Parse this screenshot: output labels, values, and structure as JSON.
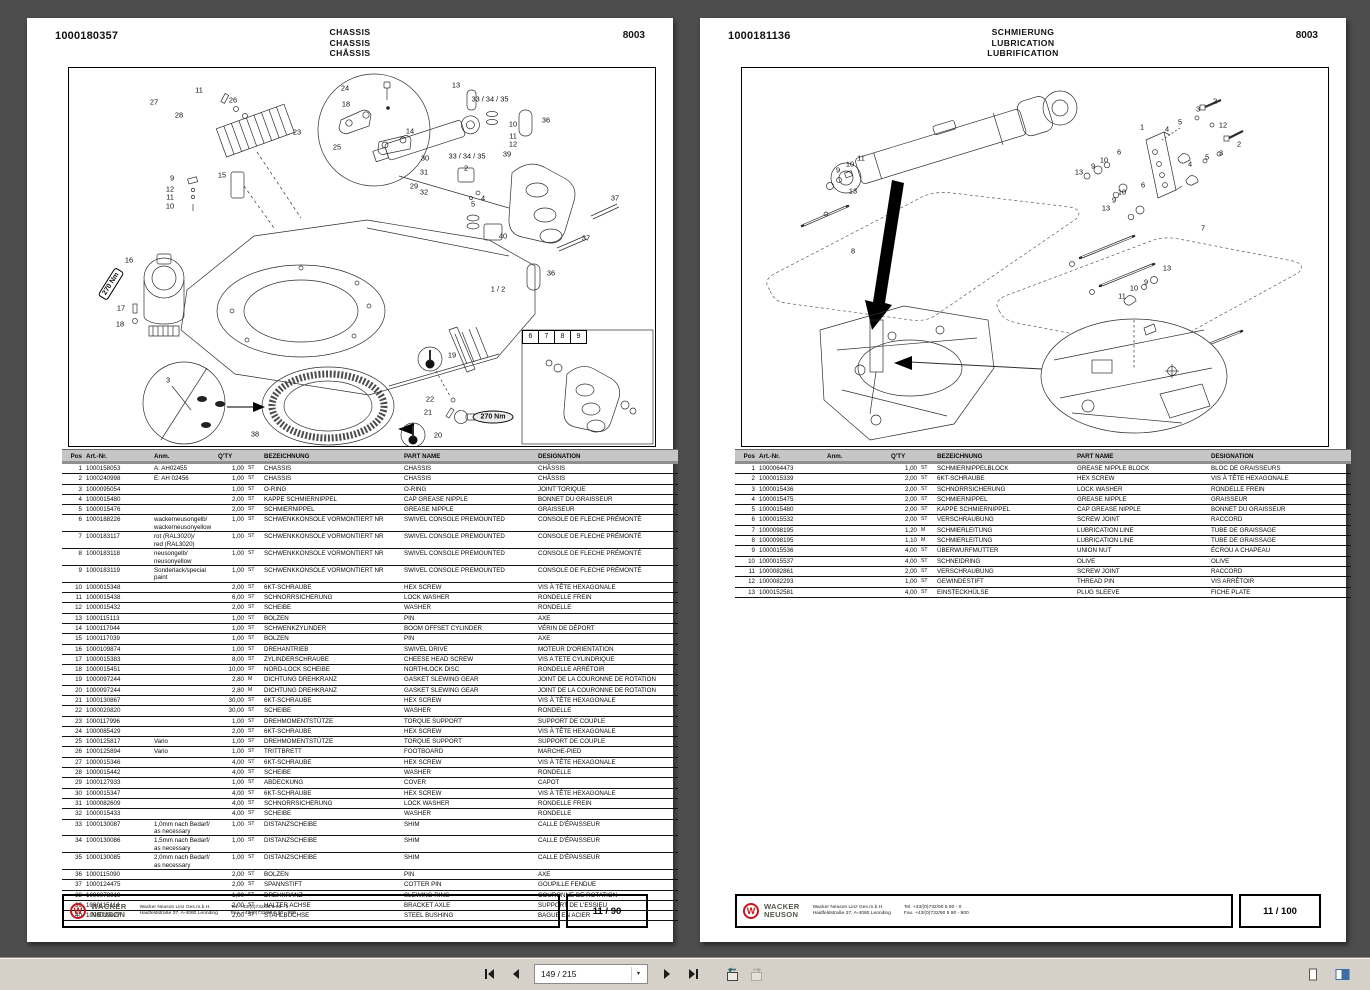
{
  "viewer": {
    "toolbar": {
      "page_field": "149 / 215",
      "icons": [
        "first-page",
        "previous-page",
        "next-page",
        "last-page",
        "previous-view",
        "next-view",
        "single-page-view",
        "facing-pages-view"
      ]
    }
  },
  "table_headers": {
    "pos": "Pos",
    "art": "Art.-Nr.",
    "anm": "Anm.",
    "qty": "Q'TY",
    "bez": "BEZEICHNUNG",
    "part": "PART NAME",
    "des": "DESIGNATION"
  },
  "footer": {
    "brand1": "WACKER",
    "brand2": "NEUSON",
    "company": "Wacker Neuson Linz  Ges.m.b.H.",
    "address": "Haidfeldstraße 37, A-4060 Leonding",
    "tel": "Tel. +43/(0)732/90 5 90 - 0",
    "fax": "Fax. +43/(0)732/90 5 90 - 900"
  },
  "left_page": {
    "doc_number": "1000180357",
    "titles": [
      "CHASSIS",
      "CHASSIS",
      "CHÂSSIS"
    ],
    "page_code": "8003",
    "page_number": "11 / 90",
    "diagram": {
      "callouts": [
        {
          "x": 85,
          "y": 34,
          "t": "27"
        },
        {
          "x": 130,
          "y": 22,
          "t": "11"
        },
        {
          "x": 110,
          "y": 47,
          "t": "28"
        },
        {
          "x": 164,
          "y": 32,
          "t": "26"
        },
        {
          "x": 276,
          "y": 20,
          "t": "24"
        },
        {
          "x": 277,
          "y": 36,
          "t": "18"
        },
        {
          "x": 228,
          "y": 64,
          "t": "23"
        },
        {
          "x": 268,
          "y": 79,
          "t": "25"
        },
        {
          "x": 387,
          "y": 17,
          "t": "13"
        },
        {
          "x": 421,
          "y": 31,
          "t": "33 / 34 / 35"
        },
        {
          "x": 341,
          "y": 63,
          "t": "14"
        },
        {
          "x": 356,
          "y": 90,
          "t": "30"
        },
        {
          "x": 398,
          "y": 88,
          "t": "33 / 34 / 35"
        },
        {
          "x": 444,
          "y": 56,
          "t": "10"
        },
        {
          "x": 444,
          "y": 68,
          "t": "11"
        },
        {
          "x": 444,
          "y": 76,
          "t": "12"
        },
        {
          "x": 438,
          "y": 86,
          "t": "39"
        },
        {
          "x": 477,
          "y": 52,
          "t": "36"
        },
        {
          "x": 345,
          "y": 118,
          "t": "29"
        },
        {
          "x": 355,
          "y": 104,
          "t": "31"
        },
        {
          "x": 355,
          "y": 124,
          "t": "32"
        },
        {
          "x": 397,
          "y": 100,
          "t": "2"
        },
        {
          "x": 414,
          "y": 130,
          "t": "4"
        },
        {
          "x": 404,
          "y": 136,
          "t": "5"
        },
        {
          "x": 153,
          "y": 107,
          "t": "15"
        },
        {
          "x": 103,
          "y": 110,
          "t": "9"
        },
        {
          "x": 101,
          "y": 121,
          "t": "12"
        },
        {
          "x": 101,
          "y": 129,
          "t": "11"
        },
        {
          "x": 101,
          "y": 138,
          "t": "10"
        },
        {
          "x": 546,
          "y": 130,
          "t": "37"
        },
        {
          "x": 517,
          "y": 170,
          "t": "37"
        },
        {
          "x": 434,
          "y": 168,
          "t": "40"
        },
        {
          "x": 482,
          "y": 205,
          "t": "36"
        },
        {
          "x": 429,
          "y": 221,
          "t": "1 / 2"
        },
        {
          "x": 60,
          "y": 192,
          "t": "16"
        },
        {
          "x": 42,
          "y": 216,
          "t": "270 Nm",
          "cls": "tag",
          "r": -58
        },
        {
          "x": 52,
          "y": 240,
          "t": "17"
        },
        {
          "x": 51,
          "y": 256,
          "t": "18"
        },
        {
          "x": 99,
          "y": 312,
          "t": "3"
        },
        {
          "x": 186,
          "y": 366,
          "t": "38"
        },
        {
          "x": 383,
          "y": 287,
          "t": "19"
        },
        {
          "x": 361,
          "y": 331,
          "t": "22"
        },
        {
          "x": 359,
          "y": 344,
          "t": "21"
        },
        {
          "x": 424,
          "y": 349,
          "t": "270 Nm",
          "cls": "oval"
        },
        {
          "x": 369,
          "y": 367,
          "t": "20"
        },
        {
          "x": 453,
          "y": 262,
          "t": "6",
          "cls": "cell"
        },
        {
          "x": 469,
          "y": 262,
          "t": "7",
          "cls": "cell"
        },
        {
          "x": 485,
          "y": 262,
          "t": "8",
          "cls": "cell"
        },
        {
          "x": 501,
          "y": 262,
          "t": "9",
          "cls": "cell"
        }
      ]
    },
    "table": {
      "rows": [
        [
          "1",
          "1000158053",
          "A: AH02455",
          "1,00",
          "ST",
          "CHASSIS",
          "CHASSIS",
          "CHÂSSIS"
        ],
        [
          "2",
          "1000240998",
          "E: AH 02456",
          "1,00",
          "ST",
          "CHASSIS",
          "CHASSIS",
          "CHÂSSIS"
        ],
        [
          "3",
          "1000095054",
          "",
          "1,00",
          "ST",
          "O-RING",
          "O-RING",
          "JOINT TORIQUE"
        ],
        [
          "4",
          "1000015480",
          "",
          "2,00",
          "ST",
          "KAPPE SCHMIERNIPPEL",
          "CAP GREASE NIPPLE",
          "BONNET DU GRAISSEUR"
        ],
        [
          "5",
          "1000015476",
          "",
          "2,00",
          "ST",
          "SCHMIERNIPPEL",
          "GREASE NIPPLE",
          "GRAISSEUR"
        ],
        [
          "6",
          "1000188226",
          "wackerneusongelb/\nwackerneusonyellow",
          "1,00",
          "ST",
          "SCHWENKKONSOLE VORMONTIERT NR",
          "SWIVEL CONSOLE PREMOUNTED",
          "CONSOLE DE FLECHE PRÉMONTÉ"
        ],
        [
          "7",
          "1000183117",
          "rot (RAL3020)/\nred (RAL3020)",
          "1,00",
          "ST",
          "SCHWENKKONSOLE VORMONTIERT NR",
          "SWIVEL CONSOLE PREMOUNTED",
          "CONSOLE DE FLECHE PRÉMONTÉ"
        ],
        [
          "8",
          "1000183118",
          "neusongelb/\nneusonyellow",
          "1,00",
          "ST",
          "SCHWENKKONSOLE VORMONTIERT NR",
          "SWIVEL CONSOLE PREMOUNTED",
          "CONSOLE DE FLECHE PRÉMONTÉ"
        ],
        [
          "9",
          "1000183119",
          "Sonderlack/special paint",
          "1,00",
          "ST",
          "SCHWENKKONSOLE VORMONTIERT NR",
          "SWIVEL CONSOLE PREMOUNTED",
          "CONSOLE DE FLECHE PRÉMONTÉ"
        ],
        [
          "10",
          "1000015348",
          "",
          "2,00",
          "ST",
          "6KT-SCHRAUBE",
          "HEX SCREW",
          "VIS À TÊTE HEXAGONALE"
        ],
        [
          "11",
          "1000015438",
          "",
          "6,00",
          "ST",
          "SCHNORRSICHERUNG",
          "LOCK WASHER",
          "RONDELLE FREIN"
        ],
        [
          "12",
          "1000015432",
          "",
          "2,00",
          "ST",
          "SCHEIBE",
          "WASHER",
          "RONDELLE"
        ],
        [
          "13",
          "1000115113",
          "",
          "1,00",
          "ST",
          "BOLZEN",
          "PIN",
          "AXE"
        ],
        [
          "14",
          "1000117044",
          "",
          "1,00",
          "ST",
          "SCHWENKZYLINDER",
          "BOOM OFFSET CYLINDER",
          "VÉRIN DE DÉPORT"
        ],
        [
          "15",
          "1000117039",
          "",
          "1,00",
          "ST",
          "BOLZEN",
          "PIN",
          "AXE"
        ],
        [
          "16",
          "1000109874",
          "",
          "1,00",
          "ST",
          "DREHANTRIEB",
          "SWIVEL DRIVE",
          "MOTEUR D'ORIENTATION"
        ],
        [
          "17",
          "1000015383",
          "",
          "8,00",
          "ST",
          "ZYLINDERSCHRAUBE",
          "CHEESE HEAD SCREW",
          "VIS A TETE CYLINDRIQUE"
        ],
        [
          "18",
          "1000015451",
          "",
          "10,00",
          "ST",
          "NORD-LOCK SCHEIBE",
          "NORTHLOCK DISC",
          "RONDELLE ARRÉTOIR"
        ],
        [
          "19",
          "1000097244",
          "",
          "2,80",
          "M",
          "DICHTUNG DREHKRANZ",
          "GASKET SLEWING GEAR",
          "JOINT DE LA COURONNE DE ROTATION"
        ],
        [
          "20",
          "1000097244",
          "",
          "2,80",
          "M",
          "DICHTUNG DREHKRANZ",
          "GASKET SLEWING GEAR",
          "JOINT DE LA COURONNE DE ROTATION"
        ],
        [
          "21",
          "1000130867",
          "",
          "30,00",
          "ST",
          "6KT-SCHRAUBE",
          "HEX SCREW",
          "VIS À TÊTE HEXAGONALE"
        ],
        [
          "22",
          "1000020820",
          "",
          "30,00",
          "ST",
          "SCHEIBE",
          "WASHER",
          "RONDELLE"
        ],
        [
          "23",
          "1000117996",
          "",
          "1,00",
          "ST",
          "DREHMOMENTSTÜTZE",
          "TORQUE SUPPORT",
          "SUPPORT DE COUPLE"
        ],
        [
          "24",
          "1000085429",
          "",
          "2,00",
          "ST",
          "6KT-SCHRAUBE",
          "HEX SCREW",
          "VIS À TÊTE HEXAGONALE"
        ],
        [
          "25",
          "1000125817",
          "Vario",
          "1,00",
          "ST",
          "DREHMOMENTSTÜTZE",
          "TORQUE SUPPORT",
          "SUPPORT DE COUPLE"
        ],
        [
          "26",
          "1000125894",
          "Vario",
          "1,00",
          "ST",
          "TRITTBRETT",
          "FOOTBOARD",
          "MARCHE-PIED"
        ],
        [
          "27",
          "1000015346",
          "",
          "4,00",
          "ST",
          "6KT-SCHRAUBE",
          "HEX SCREW",
          "VIS À TÊTE HEXAGONALE"
        ],
        [
          "28",
          "1000015442",
          "",
          "4,00",
          "ST",
          "SCHEIBE",
          "WASHER",
          "RONDELLE"
        ],
        [
          "29",
          "1000127933",
          "",
          "1,00",
          "ST",
          "ABDECKUNG",
          "COVER",
          "CAPOT"
        ],
        [
          "30",
          "1000015347",
          "",
          "4,00",
          "ST",
          "6KT-SCHRAUBE",
          "HEX SCREW",
          "VIS À TÊTE HEXAGONALE"
        ],
        [
          "31",
          "1000082609",
          "",
          "4,00",
          "ST",
          "SCHNORRSICHERUNG",
          "LOCK WASHER",
          "RONDELLE FREIN"
        ],
        [
          "32",
          "1000015433",
          "",
          "4,00",
          "ST",
          "SCHEIBE",
          "WASHER",
          "RONDELLE"
        ],
        [
          "33",
          "1000130087",
          "1,0mm nach Bedarf/\nas necessary",
          "1,00",
          "ST",
          "DISTANZSCHEIBE",
          "SHIM",
          "CALLE D'ÉPAISSEUR"
        ],
        [
          "34",
          "1000130086",
          "1,5mm nach Bedarf/\nas necessary",
          "1,00",
          "ST",
          "DISTANZSCHEIBE",
          "SHIM",
          "CALLE D'ÉPAISSEUR"
        ],
        [
          "35",
          "1000130085",
          "2,0mm nach Bedarf/\nas necessary",
          "1,00",
          "ST",
          "DISTANZSCHEIBE",
          "SHIM",
          "CALLE D'ÉPAISSEUR"
        ],
        [
          "36",
          "1000115090",
          "",
          "2,00",
          "ST",
          "BOLZEN",
          "PIN",
          "AXE"
        ],
        [
          "37",
          "1000124475",
          "",
          "2,00",
          "ST",
          "SPANNSTIFT",
          "COTTER PIN",
          "GOUPILLE FENDUE"
        ],
        [
          "38",
          "1000078919",
          "",
          "1,00",
          "ST",
          "DREHKRANZ",
          "SLEWING RING",
          "COURONNE DE ROTATION"
        ],
        [
          "39",
          "1000115114",
          "",
          "2,00",
          "ST",
          "HALTER ACHSE",
          "BRACKET AXLE",
          "SUPPORT DE L'ESSIEU"
        ],
        [
          "40",
          "1000019027",
          "",
          "2,00",
          "ST",
          "STAHLBUCHSE",
          "STEEL BUSHING",
          "BAGUE EN ACIER"
        ]
      ]
    }
  },
  "right_page": {
    "doc_number": "1000181136",
    "titles": [
      "SCHMIERUNG",
      "LUBRICATION",
      "LUBRIFICATION"
    ],
    "page_code": "8003",
    "page_number": "11 / 100",
    "diagram": {
      "callouts": [
        {
          "x": 119,
          "y": 90,
          "t": "11"
        },
        {
          "x": 108,
          "y": 96,
          "t": "10"
        },
        {
          "x": 96,
          "y": 102,
          "t": "9"
        },
        {
          "x": 111,
          "y": 123,
          "t": "13"
        },
        {
          "x": 111,
          "y": 183,
          "t": "8"
        },
        {
          "x": 400,
          "y": 59,
          "t": "1"
        },
        {
          "x": 473,
          "y": 33,
          "t": "2"
        },
        {
          "x": 456,
          "y": 41,
          "t": "3"
        },
        {
          "x": 438,
          "y": 54,
          "t": "5"
        },
        {
          "x": 425,
          "y": 61,
          "t": "4"
        },
        {
          "x": 481,
          "y": 57,
          "t": "12"
        },
        {
          "x": 497,
          "y": 76,
          "t": "2"
        },
        {
          "x": 479,
          "y": 85,
          "t": "3"
        },
        {
          "x": 465,
          "y": 89,
          "t": "5"
        },
        {
          "x": 448,
          "y": 96,
          "t": "4"
        },
        {
          "x": 377,
          "y": 84,
          "t": "6"
        },
        {
          "x": 362,
          "y": 92,
          "t": "10"
        },
        {
          "x": 351,
          "y": 98,
          "t": "9"
        },
        {
          "x": 337,
          "y": 104,
          "t": "13"
        },
        {
          "x": 401,
          "y": 117,
          "t": "6"
        },
        {
          "x": 380,
          "y": 124,
          "t": "10"
        },
        {
          "x": 372,
          "y": 132,
          "t": "9"
        },
        {
          "x": 364,
          "y": 140,
          "t": "13"
        },
        {
          "x": 461,
          "y": 160,
          "t": "7"
        },
        {
          "x": 425,
          "y": 200,
          "t": "13"
        },
        {
          "x": 404,
          "y": 214,
          "t": "9"
        },
        {
          "x": 392,
          "y": 220,
          "t": "10"
        },
        {
          "x": 380,
          "y": 228,
          "t": "11"
        }
      ]
    },
    "table": {
      "rows": [
        [
          "1",
          "1000064473",
          "",
          "1,00",
          "ST",
          "SCHMIERNIPPELBLOCK",
          "GREASE NIPPLE BLOCK",
          "BLOC DE GRAISSEURS"
        ],
        [
          "2",
          "1000015339",
          "",
          "2,00",
          "ST",
          "6KT-SCHRAUBE",
          "HEX SCREW",
          "VIS À TÊTE HEXAGONALE"
        ],
        [
          "3",
          "1000015436",
          "",
          "2,00",
          "ST",
          "SCHNORRSICHERUNG",
          "LOCK WASHER",
          "RONDELLE FREIN"
        ],
        [
          "4",
          "1000015475",
          "",
          "2,00",
          "ST",
          "SCHMIERNIPPEL",
          "GREASE NIPPLE",
          "GRAISSEUR"
        ],
        [
          "5",
          "1000015480",
          "",
          "2,00",
          "ST",
          "KAPPE SCHMIERNIPPEL",
          "CAP GREASE NIPPLE",
          "BONNET DU GRAISSEUR"
        ],
        [
          "6",
          "1000015532",
          "",
          "2,00",
          "ST",
          "VERSCHRAUBUNG",
          "SCREW JOINT",
          "RACCORD"
        ],
        [
          "7",
          "1000098195",
          "",
          "1,20",
          "M",
          "SCHMIERLEITUNG",
          "LUBRICATION LINE",
          "TUBE DE GRAISSAGE"
        ],
        [
          "8",
          "1000098195",
          "",
          "1,10",
          "M",
          "SCHMIERLEITUNG",
          "LUBRICATION LINE",
          "TUBE DE GRAISSAGE"
        ],
        [
          "9",
          "1000015536",
          "",
          "4,00",
          "ST",
          "ÜBERWURFMUTTER",
          "UNION NUT",
          "ÉCROU A CHAPEAU"
        ],
        [
          "10",
          "1000015537",
          "",
          "4,00",
          "ST",
          "SCHNEIDRING",
          "OLIVE",
          "OLIVE"
        ],
        [
          "11",
          "1000082861",
          "",
          "2,00",
          "ST",
          "VERSCHRAUBUNG",
          "SCREW JOINT",
          "RACCORD"
        ],
        [
          "12",
          "1000082293",
          "",
          "1,00",
          "ST",
          "GEWINDESTIFT",
          "THREAD PIN",
          "VIS ARRÊTOIR"
        ],
        [
          "13",
          "1000152581",
          "",
          "4,00",
          "ST",
          "EINSTECKHÜLSE",
          "PLUG SLEEVE",
          "FICHE PLATE"
        ]
      ]
    }
  }
}
